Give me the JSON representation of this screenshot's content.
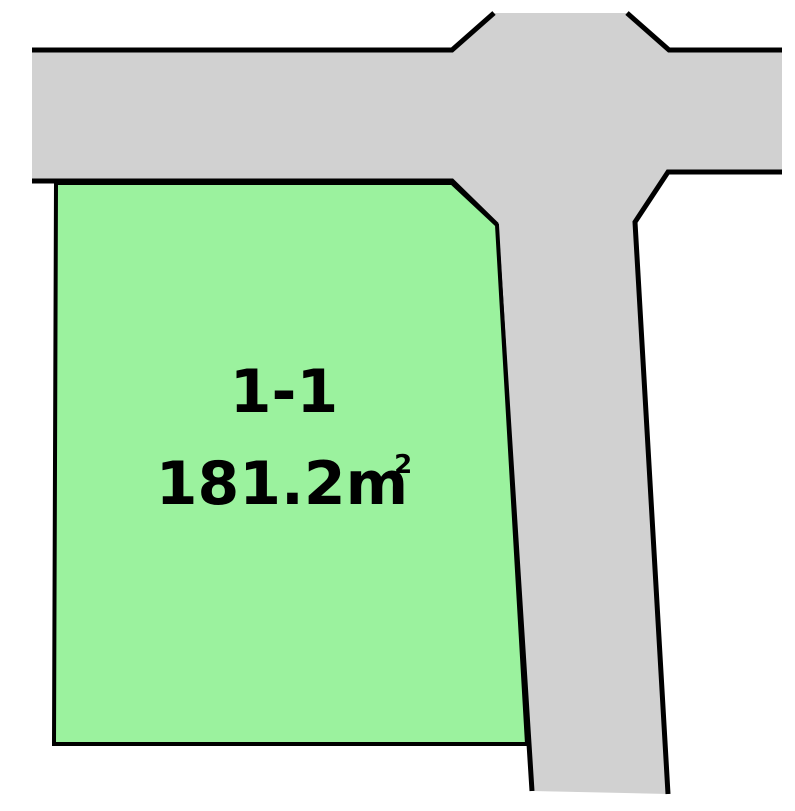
{
  "canvas": {
    "background": "#ffffff"
  },
  "colors": {
    "road_fill": "#d1d1d1",
    "parcel_fill": "#9bf29e",
    "outline": "#000000",
    "label_text": "#000000"
  },
  "parcel": {
    "lot_number": "1-1",
    "area_value": "181.2",
    "area_unit_base": "m",
    "area_unit_exponent": "2"
  }
}
